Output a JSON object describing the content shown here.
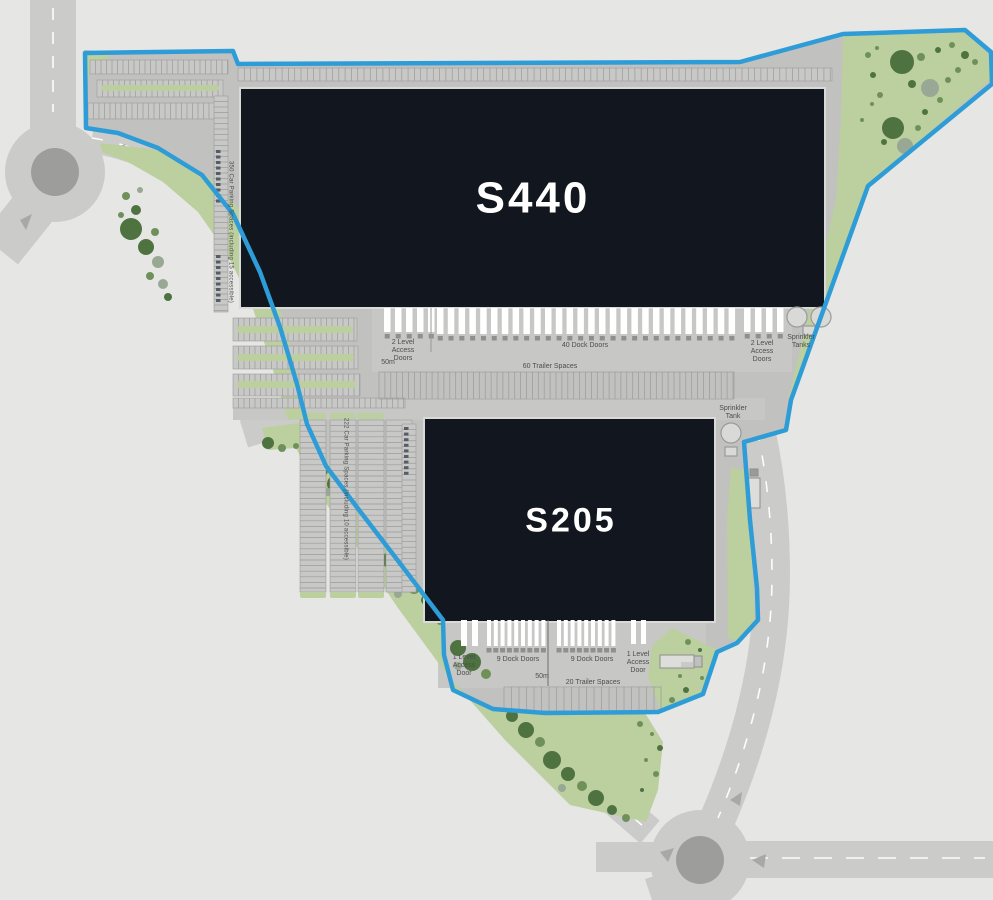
{
  "plan": {
    "title": "Logistics park site plan",
    "buildings": [
      {
        "id": "s440",
        "name": "S440"
      },
      {
        "id": "s205",
        "name": "S205"
      }
    ],
    "s440": {
      "access_left": "2 Level Access Doors",
      "dock_doors": "40 Dock Doors",
      "access_right": "2 Level Access Doors",
      "sprinkler": "Sprinkler Tanks",
      "scale": "50m",
      "trailers": "60 Trailer Spaces",
      "parking": "350 Car Parking Spaces (including 15 accessible)"
    },
    "s205": {
      "sprinkler": "Sprinkler Tank",
      "access_left": "1 Level Access Door",
      "dock_doors_a": "9 Dock Doors",
      "dock_doors_b": "9 Dock Doors",
      "access_right": "1 Level Access Door",
      "scale": "50m",
      "trailers": "20 Trailer Spaces",
      "parking": "222 Car Parking Spaces (including 10 accessible)"
    },
    "colors": {
      "background": "#e6e6e5",
      "road": "#cbcbca",
      "roundabout": "#9d9d9c",
      "pavement": "#c1c1c0",
      "building": "#12161f",
      "building_text": "#ffffff",
      "green": "#bccf9f",
      "tree_dark": "#4e7340",
      "tree_mid": "#6f9159",
      "tree_gray": "#98a894",
      "boundary": "#2e9cd6",
      "label_text": "#4d4d4d"
    }
  }
}
